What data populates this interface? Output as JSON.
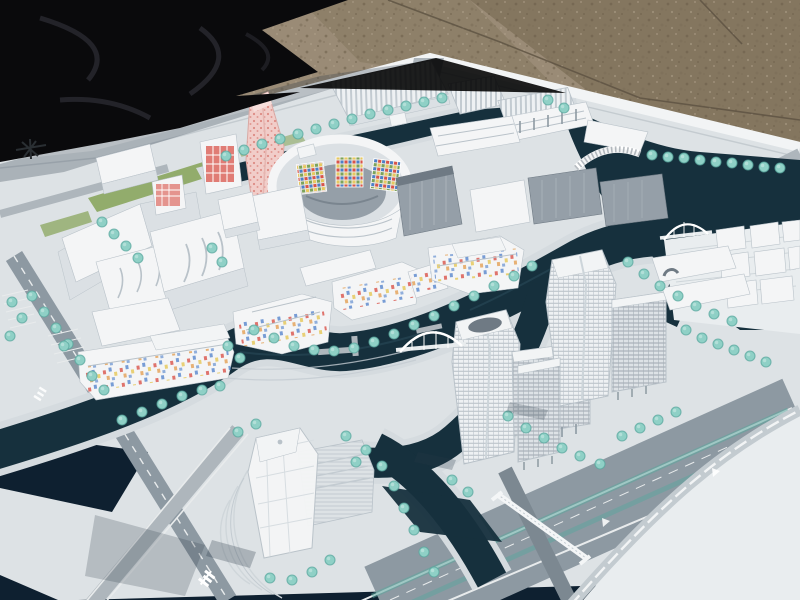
{
  "scene": {
    "type": "photograph",
    "subject": "architectural scale model of a waterfront urban master plan displayed outdoors on a white presentation board",
    "setting": {
      "ground": "brown gravel pavement with crack lines",
      "covering": "black tarp draped at the upper left corner",
      "board": "white model base board seen at an oblique angle"
    },
    "palette": {
      "gravel_light": "#9a8b76",
      "gravel_mid": "#8e8069",
      "gravel_dark": "#84765f",
      "gravel_speck": "#6b5d49",
      "gravel_crack": "#5c5141",
      "tarp": "#0a0a0c",
      "tarp_sheen": "#26262c",
      "board": "#dde2e5",
      "board_rim": "#f2f4f5",
      "board_bright": "#e9edef",
      "road": "#8d99a2",
      "road_dark": "#7c8891",
      "road_light": "#aeb6bc",
      "lane": "#e8ebec",
      "water": "#16303d",
      "water_deep": "#0e2030",
      "water_glint": "#2a4a58",
      "bank": "#d5dbdf",
      "tree": "#8fd0c6",
      "tree_dark": "#58a79e",
      "tree_light": "#b8e2db",
      "bldg": "#f4f5f6",
      "bldg_side": "#dbe0e4",
      "bldg_shade": "#b9c2c9",
      "glass_gray": "#959fa8",
      "glass_dark": "#6f7a84",
      "pink": "#f1cdc9",
      "pink_dot": "#dd8b84",
      "accent_red": "#d9534a",
      "accent_blue": "#4d7fc9",
      "accent_yellow": "#e7c95f",
      "accent_orange": "#e2943f",
      "accent_green": "#7ba35b",
      "lawn": "#8aa65e",
      "shadow": "#283746"
    },
    "elements": [
      "gravel-ground",
      "black-tarp",
      "model-board",
      "board-north-mark",
      "pink-dotted-tower",
      "oval-arena-block",
      "mosaic-facade-panels",
      "sawtooth-roof-industrial-row",
      "gray-glass-slabs",
      "left-curved-office-complex",
      "confetti-window-housing-clusters",
      "center-office-tower",
      "right-twin-tower-cluster",
      "right-edge-cube-cluster",
      "island-translucent-tower",
      "circular-plaza",
      "canal-network",
      "arch-bridge-center",
      "arch-bridge-east",
      "lattice-bridge",
      "glass-bead-trees",
      "boulevard-with-medians",
      "curved-ramp",
      "footbridge",
      "road-glyph-marking"
    ]
  }
}
